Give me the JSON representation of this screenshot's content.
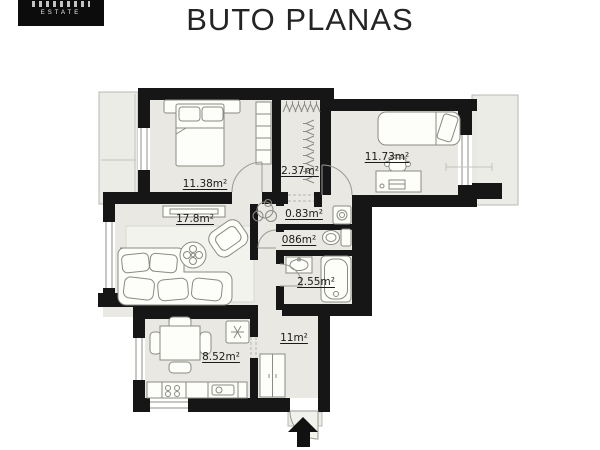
{
  "logo": {
    "estate": "ESTATE"
  },
  "title": "BUTO PLANAS",
  "rooms": {
    "bedroom1": {
      "area": "11.38m²"
    },
    "closet": {
      "area": "2.37m²"
    },
    "bedroom2": {
      "area": "11.73m²"
    },
    "niche": {
      "area": "0.83m²"
    },
    "wc": {
      "area": "086m²"
    },
    "bathroom": {
      "area": "2.55m²"
    },
    "living": {
      "area": "17.8m²"
    },
    "kitchen": {
      "area": "8.52m²"
    },
    "hallway": {
      "area": "11m²"
    }
  },
  "colors": {
    "wall": "#161616",
    "floor": "#e9e8e2",
    "furniture_stroke": "#8b8b84",
    "label": "#1b1b1b",
    "arrow": "#111111"
  }
}
